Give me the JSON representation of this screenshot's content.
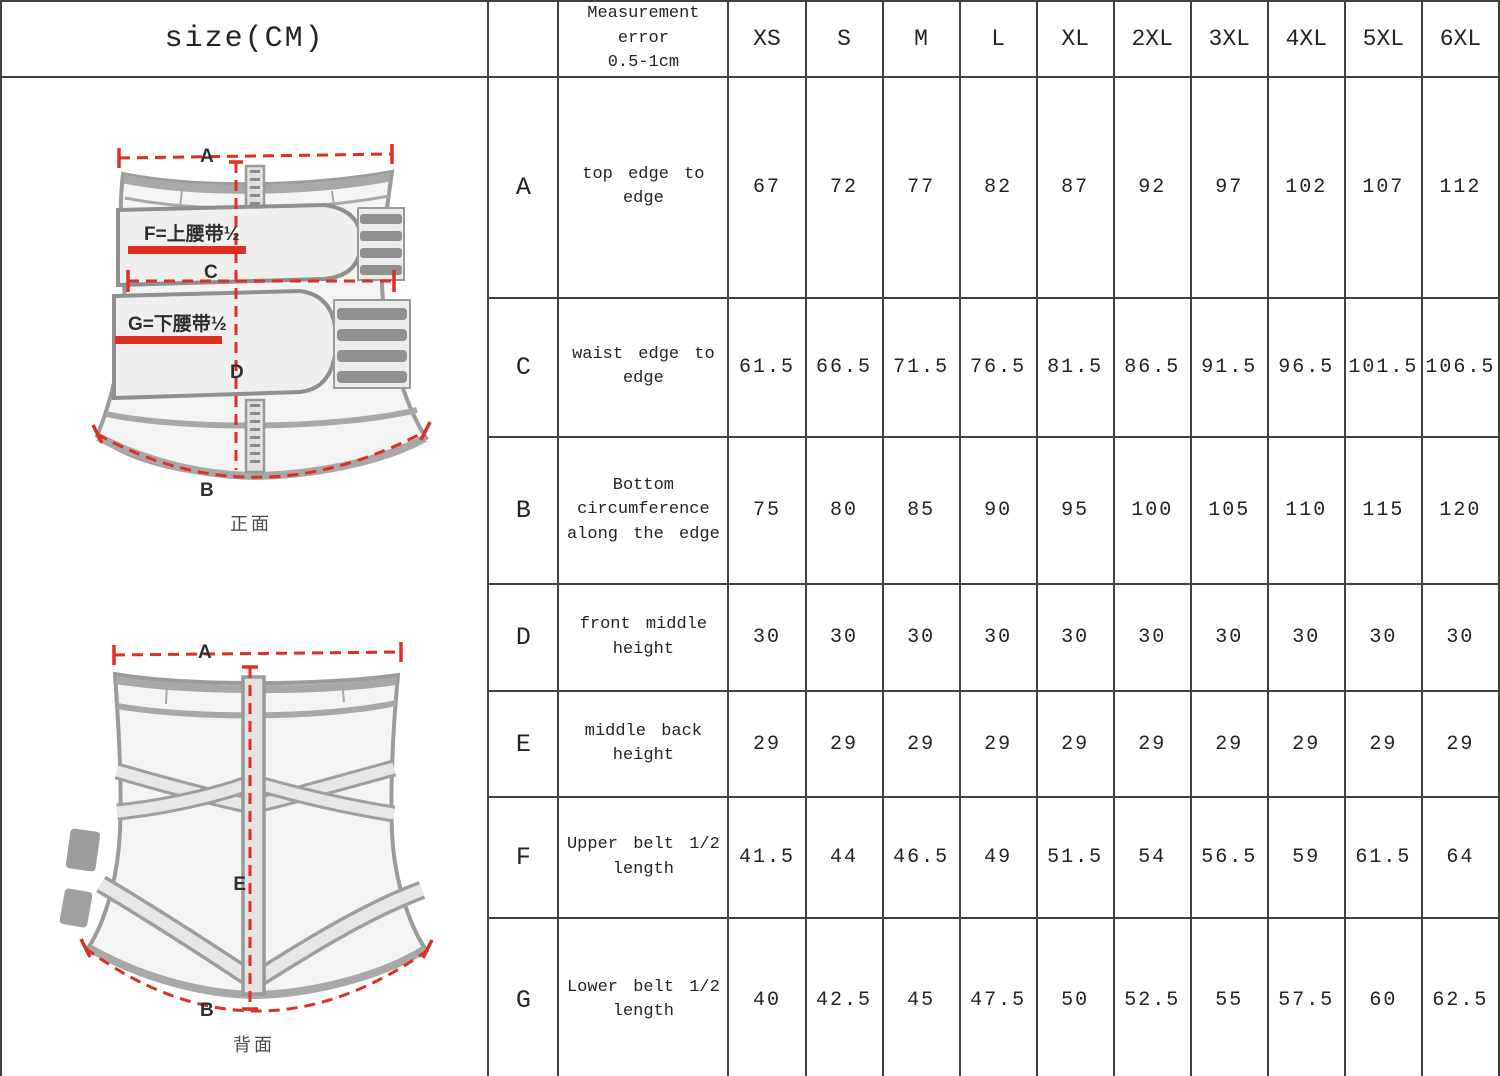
{
  "chart_data": {
    "type": "table",
    "title": "size(CM)",
    "error_note": "Measurement\nerror\n0.5-1cm",
    "unit": "cm",
    "sizes": [
      "XS",
      "S",
      "M",
      "L",
      "XL",
      "2XL",
      "3XL",
      "4XL",
      "5XL",
      "6XL"
    ],
    "rows": [
      {
        "code": "A",
        "desc": "top edge to\nedge",
        "values": [
          67,
          72,
          77,
          82,
          87,
          92,
          97,
          102,
          107,
          112
        ]
      },
      {
        "code": "C",
        "desc": "waist edge to\nedge",
        "values": [
          61.5,
          66.5,
          71.5,
          76.5,
          81.5,
          86.5,
          91.5,
          96.5,
          101.5,
          106.5
        ]
      },
      {
        "code": "B",
        "desc": "Bottom\ncircumference\nalong the edge",
        "values": [
          75,
          80,
          85,
          90,
          95,
          100,
          105,
          110,
          115,
          120
        ]
      },
      {
        "code": "D",
        "desc": "front middle\nheight",
        "values": [
          30,
          30,
          30,
          30,
          30,
          30,
          30,
          30,
          30,
          30
        ]
      },
      {
        "code": "E",
        "desc": "middle back\nheight",
        "values": [
          29,
          29,
          29,
          29,
          29,
          29,
          29,
          29,
          29,
          29
        ]
      },
      {
        "code": "F",
        "desc": "Upper belt 1/2\nlength",
        "values": [
          41.5,
          44,
          46.5,
          49,
          51.5,
          54,
          56.5,
          59,
          61.5,
          64
        ]
      },
      {
        "code": "G",
        "desc": "Lower belt 1/2\nlength",
        "values": [
          40,
          42.5,
          45,
          47.5,
          50,
          52.5,
          55,
          57.5,
          60,
          62.5
        ]
      }
    ]
  },
  "diagrams": {
    "front": {
      "caption": "正面",
      "label_a": "A",
      "label_c": "C",
      "label_b": "B",
      "label_d": "D",
      "upper_belt_label": "F=上腰带½",
      "lower_belt_label": "G=下腰带½"
    },
    "back": {
      "caption": "背面",
      "label_a": "A",
      "label_e": "E",
      "label_b": "B"
    }
  },
  "colors": {
    "measure_red": "#df2e22",
    "grid_line": "#414141",
    "text": "#232323",
    "sketch_gray": "#9b9b9b"
  }
}
